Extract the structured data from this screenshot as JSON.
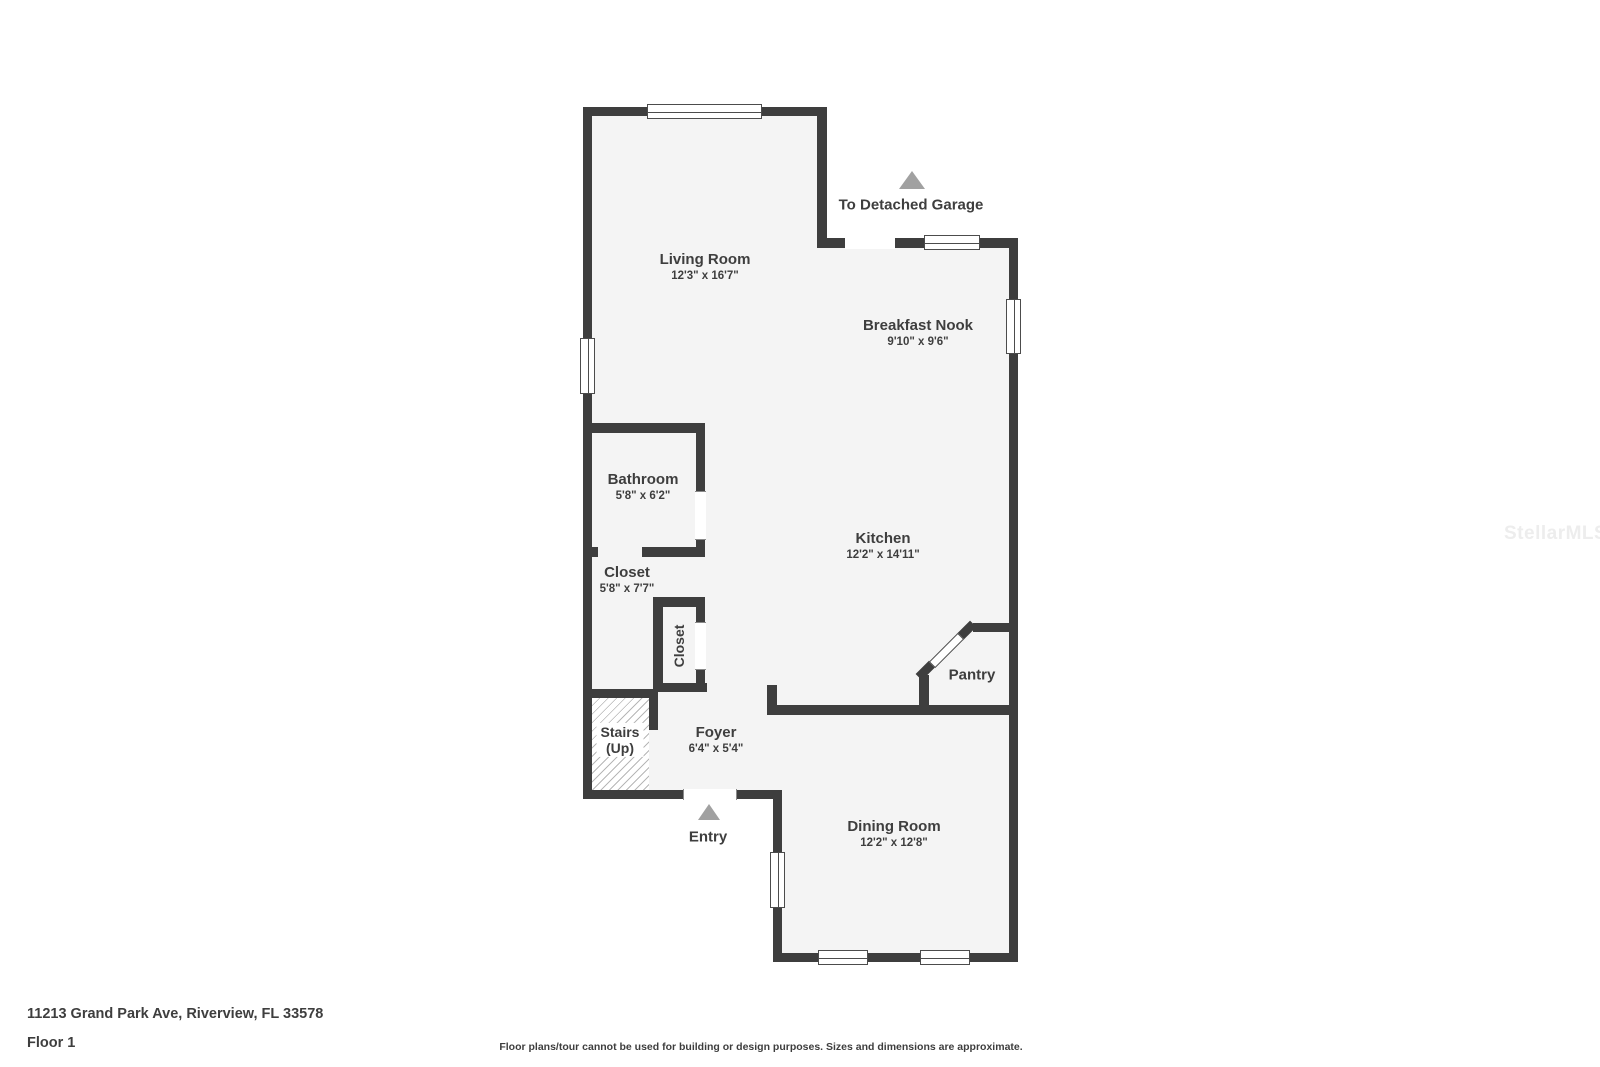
{
  "floorplan": {
    "rooms": {
      "living": {
        "name": "Living Room",
        "dims": "12'3\" x 16'7\""
      },
      "nook": {
        "name": "Breakfast Nook",
        "dims": "9'10\" x 9'6\""
      },
      "bathroom": {
        "name": "Bathroom",
        "dims": "5'8\" x 6'2\""
      },
      "closet": {
        "name": "Closet",
        "dims": "5'8\" x 7'7\""
      },
      "kitchen": {
        "name": "Kitchen",
        "dims": "12'2\" x 14'11\""
      },
      "foyer": {
        "name": "Foyer",
        "dims": "6'4\" x 5'4\""
      },
      "dining": {
        "name": "Dining Room",
        "dims": "12'2\" x 12'8\""
      },
      "pantry": {
        "name": "Pantry"
      },
      "closet_inner": {
        "name": "Closet"
      },
      "stairs": {
        "line1": "Stairs",
        "line2": "(Up)"
      }
    },
    "annotations": {
      "garage": "To Detached Garage",
      "entry": "Entry"
    }
  },
  "footer": {
    "address": "11213 Grand Park Ave, Riverview, FL 33578",
    "floor": "Floor 1",
    "disclaimer": "Floor plans/tour cannot be used for building or design purposes. Sizes and dimensions are approximate."
  },
  "watermark": "StellarMLS",
  "colors": {
    "wall": "#3e3e3e",
    "floor": "#f4f4f4",
    "text": "#3e3e3e",
    "triangle": "#a1a1a1",
    "watermark": "#ededed"
  }
}
